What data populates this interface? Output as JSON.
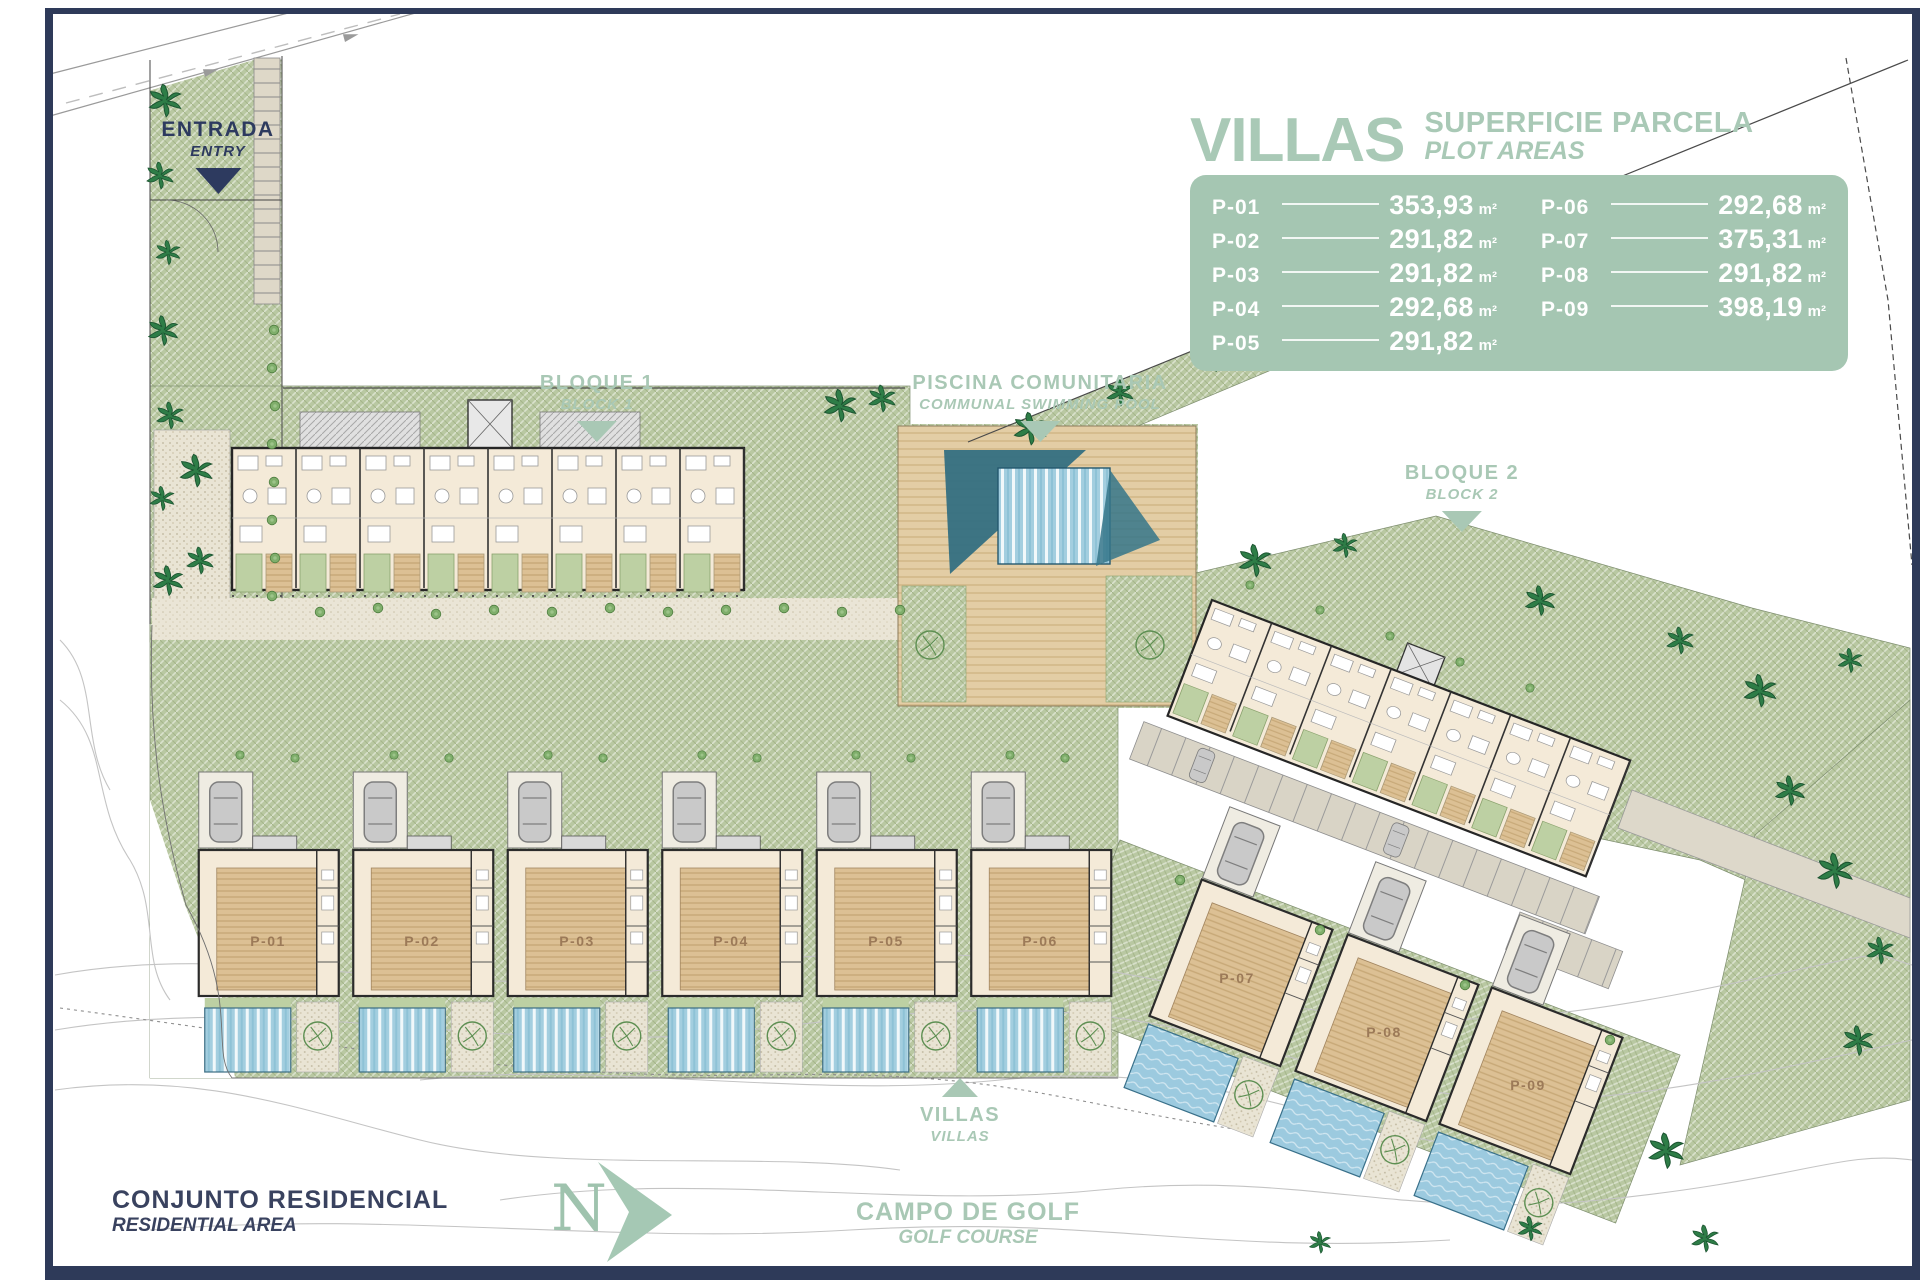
{
  "legend": {
    "title": "VILLAS",
    "subtitle_es": "SUPERFICIE PARCELA",
    "subtitle_en": "PLOT AREAS",
    "unit": "m²",
    "plots": [
      {
        "id": "P-01",
        "area": "353,93"
      },
      {
        "id": "P-02",
        "area": "291,82"
      },
      {
        "id": "P-03",
        "area": "291,82"
      },
      {
        "id": "P-04",
        "area": "292,68"
      },
      {
        "id": "P-05",
        "area": "291,82"
      },
      {
        "id": "P-06",
        "area": "292,68"
      },
      {
        "id": "P-07",
        "area": "375,31"
      },
      {
        "id": "P-08",
        "area": "291,82"
      },
      {
        "id": "P-09",
        "area": "398,19"
      }
    ]
  },
  "annotations": {
    "entry": {
      "es": "ENTRADA",
      "en": "ENTRY"
    },
    "block1": {
      "es": "BLOQUE 1",
      "en": "BLOCK 1"
    },
    "communal_pool": {
      "es": "PISCINA COMUNITARIA",
      "en": "COMMUNAL SWIMMING POOL"
    },
    "block2": {
      "es": "BLOQUE 2",
      "en": "BLOCK 2"
    },
    "villas": {
      "es": "VILLAS",
      "en": "VILLAS"
    },
    "residential_area": {
      "es": "CONJUNTO RESIDENCIAL",
      "en": "RESIDENTIAL AREA"
    },
    "golf_course": {
      "es": "CAMPO DE GOLF",
      "en": "GOLF COURSE"
    },
    "north": "N"
  },
  "colors": {
    "accent_sage": "#a9c8b5",
    "panel_green": "#a5c6b2",
    "frame_navy": "#2e3a59",
    "site_green": "#b9c8a2",
    "pool_blue": "#a3cedf",
    "deck_tan": "#dcc094"
  }
}
